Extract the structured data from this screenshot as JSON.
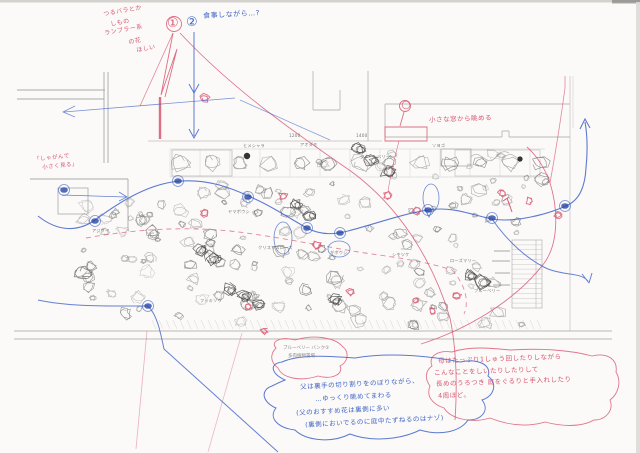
{
  "colors": {
    "red_pen": "#d85570",
    "blue_pen": "#3f63c8",
    "blue_dark": "#2b49a8",
    "pencil": "#9a9a9a"
  },
  "markers": {
    "one": "①",
    "two": "②"
  },
  "annotations": {
    "top_left_red": [
      "つるバラとか",
      "しもの",
      "ランブラー系",
      "の花",
      "ほしい"
    ],
    "meal_note_blue": "食事しながら…?",
    "crouch_note_red": [
      "「しゃがんで",
      "小さく見る」"
    ],
    "window_note_red": "小さな窓から眺める",
    "mother_route_red": [
      "母はたっぷり1しゅう回したりしながら",
      "こんなことをしいたりしたりして",
      "長めのうろつき 庭をぐるりと手入れしたり",
      "4周ほど。"
    ],
    "father_route_blue": [
      "父は裏手の切り割りをのぼりながら、",
      "…ゆっくり眺めてまわる",
      "(父のおすすめ花は裏側に多い",
      "(裏側においでるのに庭中たずねるのはナゾ)"
    ],
    "blueberry_caption": [
      "ブルーベリー バンク②",
      "多肉植物置場"
    ]
  },
  "plan_labels": [
    "ヒメシャラ",
    "アオダモ",
    "ジューンベリー",
    "ソヨゴ",
    "1200",
    "1400",
    "ヤマボウシ",
    "アジサイ",
    "クリスマスローズ",
    "ギボウシ",
    "シモツケ",
    "ローズマリー",
    "ブルーベリー",
    "フッキソウ"
  ]
}
